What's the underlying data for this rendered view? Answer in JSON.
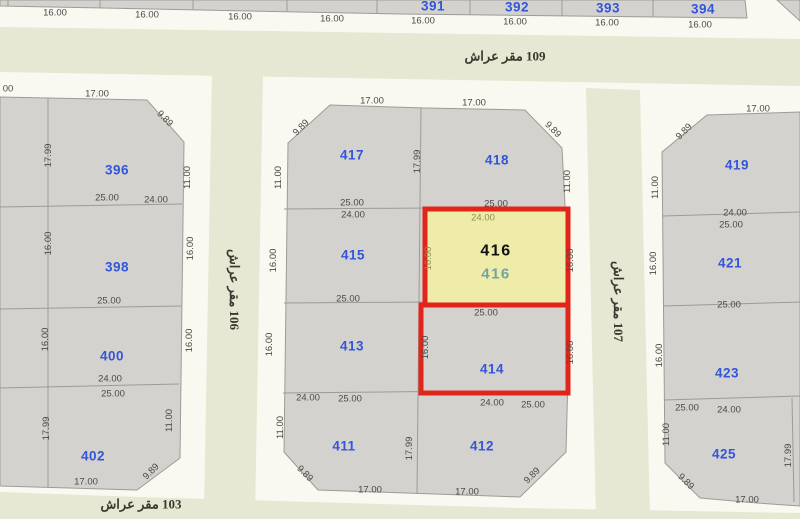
{
  "colors": {
    "gray": "#d3d2cf",
    "line": "#9c9c96",
    "sidewalk": "#faf9f1",
    "green": "#e6e8d3",
    "yellow": "#efecaa",
    "red": "#e1251b",
    "blue": "#3355d9",
    "dim": "#4b4a45",
    "olive": "#8e8e4e",
    "teal": "#73a3a1",
    "streettext": "#3a392f"
  },
  "map": {
    "streets": [
      {
        "t": "شارع رقم 109",
        "x": 505,
        "y": 57
      },
      {
        "t": "شارع رقم 106",
        "x": 230,
        "y": 286,
        "r": 90
      },
      {
        "t": "شارع رقم 107",
        "x": 614,
        "y": 298,
        "r": 90
      },
      {
        "t": "شارع رقم 103",
        "x": 141,
        "y": 505
      }
    ],
    "parcels": [
      {
        "t": "391",
        "x": 433,
        "y": 7
      },
      {
        "t": "392",
        "x": 517,
        "y": 8
      },
      {
        "t": "393",
        "x": 608,
        "y": 9
      },
      {
        "t": "394",
        "x": 703,
        "y": 10
      },
      {
        "t": "396",
        "x": 117,
        "y": 171
      },
      {
        "t": "398",
        "x": 117,
        "y": 268
      },
      {
        "t": "400",
        "x": 112,
        "y": 357
      },
      {
        "t": "402",
        "x": 93,
        "y": 457
      },
      {
        "t": "417",
        "x": 352,
        "y": 156
      },
      {
        "t": "418",
        "x": 497,
        "y": 161
      },
      {
        "t": "415",
        "x": 353,
        "y": 256
      },
      {
        "t": "413",
        "x": 352,
        "y": 347
      },
      {
        "t": "414",
        "x": 492,
        "y": 370
      },
      {
        "t": "411",
        "x": 344,
        "y": 447
      },
      {
        "t": "412",
        "x": 482,
        "y": 447
      },
      {
        "t": "419",
        "x": 737,
        "y": 166
      },
      {
        "t": "421",
        "x": 730,
        "y": 264
      },
      {
        "t": "423",
        "x": 727,
        "y": 374
      },
      {
        "t": "425",
        "x": 724,
        "y": 455
      }
    ],
    "selected": [
      {
        "t": "416",
        "x": 496,
        "y": 252,
        "c": "main"
      },
      {
        "t": "416",
        "x": 496,
        "y": 275,
        "c": "sub"
      }
    ],
    "dims": [
      {
        "t": "16.00",
        "x": 55,
        "y": 12
      },
      {
        "t": "16.00",
        "x": 147,
        "y": 14
      },
      {
        "t": "16.00",
        "x": 240,
        "y": 16
      },
      {
        "t": "16.00",
        "x": 332,
        "y": 18
      },
      {
        "t": "16.00",
        "x": 423,
        "y": 20
      },
      {
        "t": "16.00",
        "x": 515,
        "y": 21
      },
      {
        "t": "16.00",
        "x": 607,
        "y": 22
      },
      {
        "t": "16.00",
        "x": 700,
        "y": 24
      },
      {
        "t": "00",
        "x": 8,
        "y": 88
      },
      {
        "t": "17.00",
        "x": 97,
        "y": 93
      },
      {
        "t": "9.89",
        "x": 163,
        "y": 117,
        "r": 45
      },
      {
        "t": "17.99",
        "x": 51,
        "y": 152,
        "r": -90
      },
      {
        "t": "11.00",
        "x": 190,
        "y": 174,
        "r": -90
      },
      {
        "t": "25.00",
        "x": 107,
        "y": 197
      },
      {
        "t": "24.00",
        "x": 156,
        "y": 199
      },
      {
        "t": "16.00",
        "x": 51,
        "y": 240,
        "r": -90
      },
      {
        "t": "16.00",
        "x": 193,
        "y": 245,
        "r": -90
      },
      {
        "t": "25.00",
        "x": 109,
        "y": 300
      },
      {
        "t": "16.00",
        "x": 48,
        "y": 336,
        "r": -90
      },
      {
        "t": "16.00",
        "x": 192,
        "y": 337,
        "r": -90
      },
      {
        "t": "24.00",
        "x": 110,
        "y": 378
      },
      {
        "t": "25.00",
        "x": 113,
        "y": 393
      },
      {
        "t": "17.99",
        "x": 49,
        "y": 425,
        "r": -90
      },
      {
        "t": "11.00",
        "x": 172,
        "y": 417,
        "r": -90
      },
      {
        "t": "9.89",
        "x": 153,
        "y": 470,
        "r": -45
      },
      {
        "t": "17.00",
        "x": 86,
        "y": 481
      },
      {
        "t": "17.00",
        "x": 372,
        "y": 100
      },
      {
        "t": "17.00",
        "x": 474,
        "y": 102
      },
      {
        "t": "9.89",
        "x": 303,
        "y": 126,
        "r": -45
      },
      {
        "t": "9.89",
        "x": 551,
        "y": 128,
        "r": 45
      },
      {
        "t": "11.00",
        "x": 281,
        "y": 174,
        "r": -90
      },
      {
        "t": "17.99",
        "x": 420,
        "y": 158,
        "r": -90
      },
      {
        "t": "11.00",
        "x": 570,
        "y": 178,
        "r": -90
      },
      {
        "t": "25.00",
        "x": 352,
        "y": 202
      },
      {
        "t": "25.00",
        "x": 496,
        "y": 203
      },
      {
        "t": "24.00",
        "x": 353,
        "y": 214
      },
      {
        "t": "24.00",
        "x": 483,
        "y": 217,
        "c": "olive"
      },
      {
        "t": "16.00",
        "x": 276,
        "y": 257,
        "r": -90
      },
      {
        "t": "16.00",
        "x": 431,
        "y": 255,
        "r": -90,
        "c": "olive"
      },
      {
        "t": "16.00",
        "x": 573,
        "y": 257,
        "r": -90
      },
      {
        "t": "25.00",
        "x": 348,
        "y": 298
      },
      {
        "t": "25.00",
        "x": 486,
        "y": 312
      },
      {
        "t": "16.00",
        "x": 272,
        "y": 341,
        "r": -90
      },
      {
        "t": "16.00",
        "x": 428,
        "y": 344,
        "r": -90
      },
      {
        "t": "16.00",
        "x": 573,
        "y": 349,
        "r": -90
      },
      {
        "t": "24.00",
        "x": 308,
        "y": 397
      },
      {
        "t": "25.00",
        "x": 350,
        "y": 398
      },
      {
        "t": "24.00",
        "x": 492,
        "y": 402
      },
      {
        "t": "25.00",
        "x": 533,
        "y": 404
      },
      {
        "t": "11.00",
        "x": 283,
        "y": 424,
        "r": -90
      },
      {
        "t": "17.99",
        "x": 412,
        "y": 445,
        "r": -90
      },
      {
        "t": "9.89",
        "x": 303,
        "y": 472,
        "r": 45
      },
      {
        "t": "9.89",
        "x": 534,
        "y": 474,
        "r": -45
      },
      {
        "t": "17.00",
        "x": 370,
        "y": 489
      },
      {
        "t": "17.00",
        "x": 467,
        "y": 491
      },
      {
        "t": "17.00",
        "x": 758,
        "y": 108
      },
      {
        "t": "9.89",
        "x": 686,
        "y": 130,
        "r": -45
      },
      {
        "t": "11.00",
        "x": 658,
        "y": 184,
        "r": -90
      },
      {
        "t": "24.00",
        "x": 735,
        "y": 212
      },
      {
        "t": "25.00",
        "x": 731,
        "y": 224
      },
      {
        "t": "16.00",
        "x": 656,
        "y": 260,
        "r": -90
      },
      {
        "t": "25.00",
        "x": 729,
        "y": 304
      },
      {
        "t": "16.00",
        "x": 662,
        "y": 352,
        "r": -90
      },
      {
        "t": "25.00",
        "x": 687,
        "y": 407
      },
      {
        "t": "24.00",
        "x": 729,
        "y": 409
      },
      {
        "t": "11.00",
        "x": 669,
        "y": 431,
        "r": -90
      },
      {
        "t": "9.89",
        "x": 684,
        "y": 480,
        "r": 45
      },
      {
        "t": "17.00",
        "x": 747,
        "y": 499
      },
      {
        "t": "17.99",
        "x": 791,
        "y": 452,
        "r": -90
      }
    ]
  }
}
